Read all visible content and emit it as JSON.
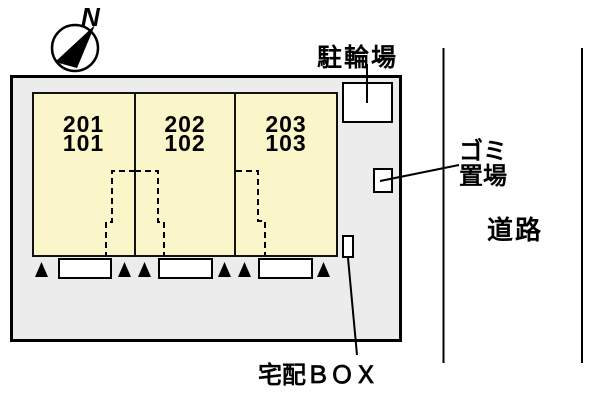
{
  "compass": {
    "north_label": "N"
  },
  "site": {
    "building": {
      "units": [
        {
          "upper": "201",
          "lower": "101"
        },
        {
          "upper": "202",
          "lower": "102"
        },
        {
          "upper": "203",
          "lower": "103"
        }
      ]
    },
    "facilities": {
      "bicycle_parking": "駐輪場",
      "garbage_area_line1": "ゴミ",
      "garbage_area_line2": "置場",
      "delivery_box": "宅配ＢＯＸ"
    },
    "road_label": "道路"
  },
  "colors": {
    "site_fill": "#ececec",
    "building_fill": "#faf6ca",
    "line": "#000000",
    "background": "#ffffff"
  }
}
